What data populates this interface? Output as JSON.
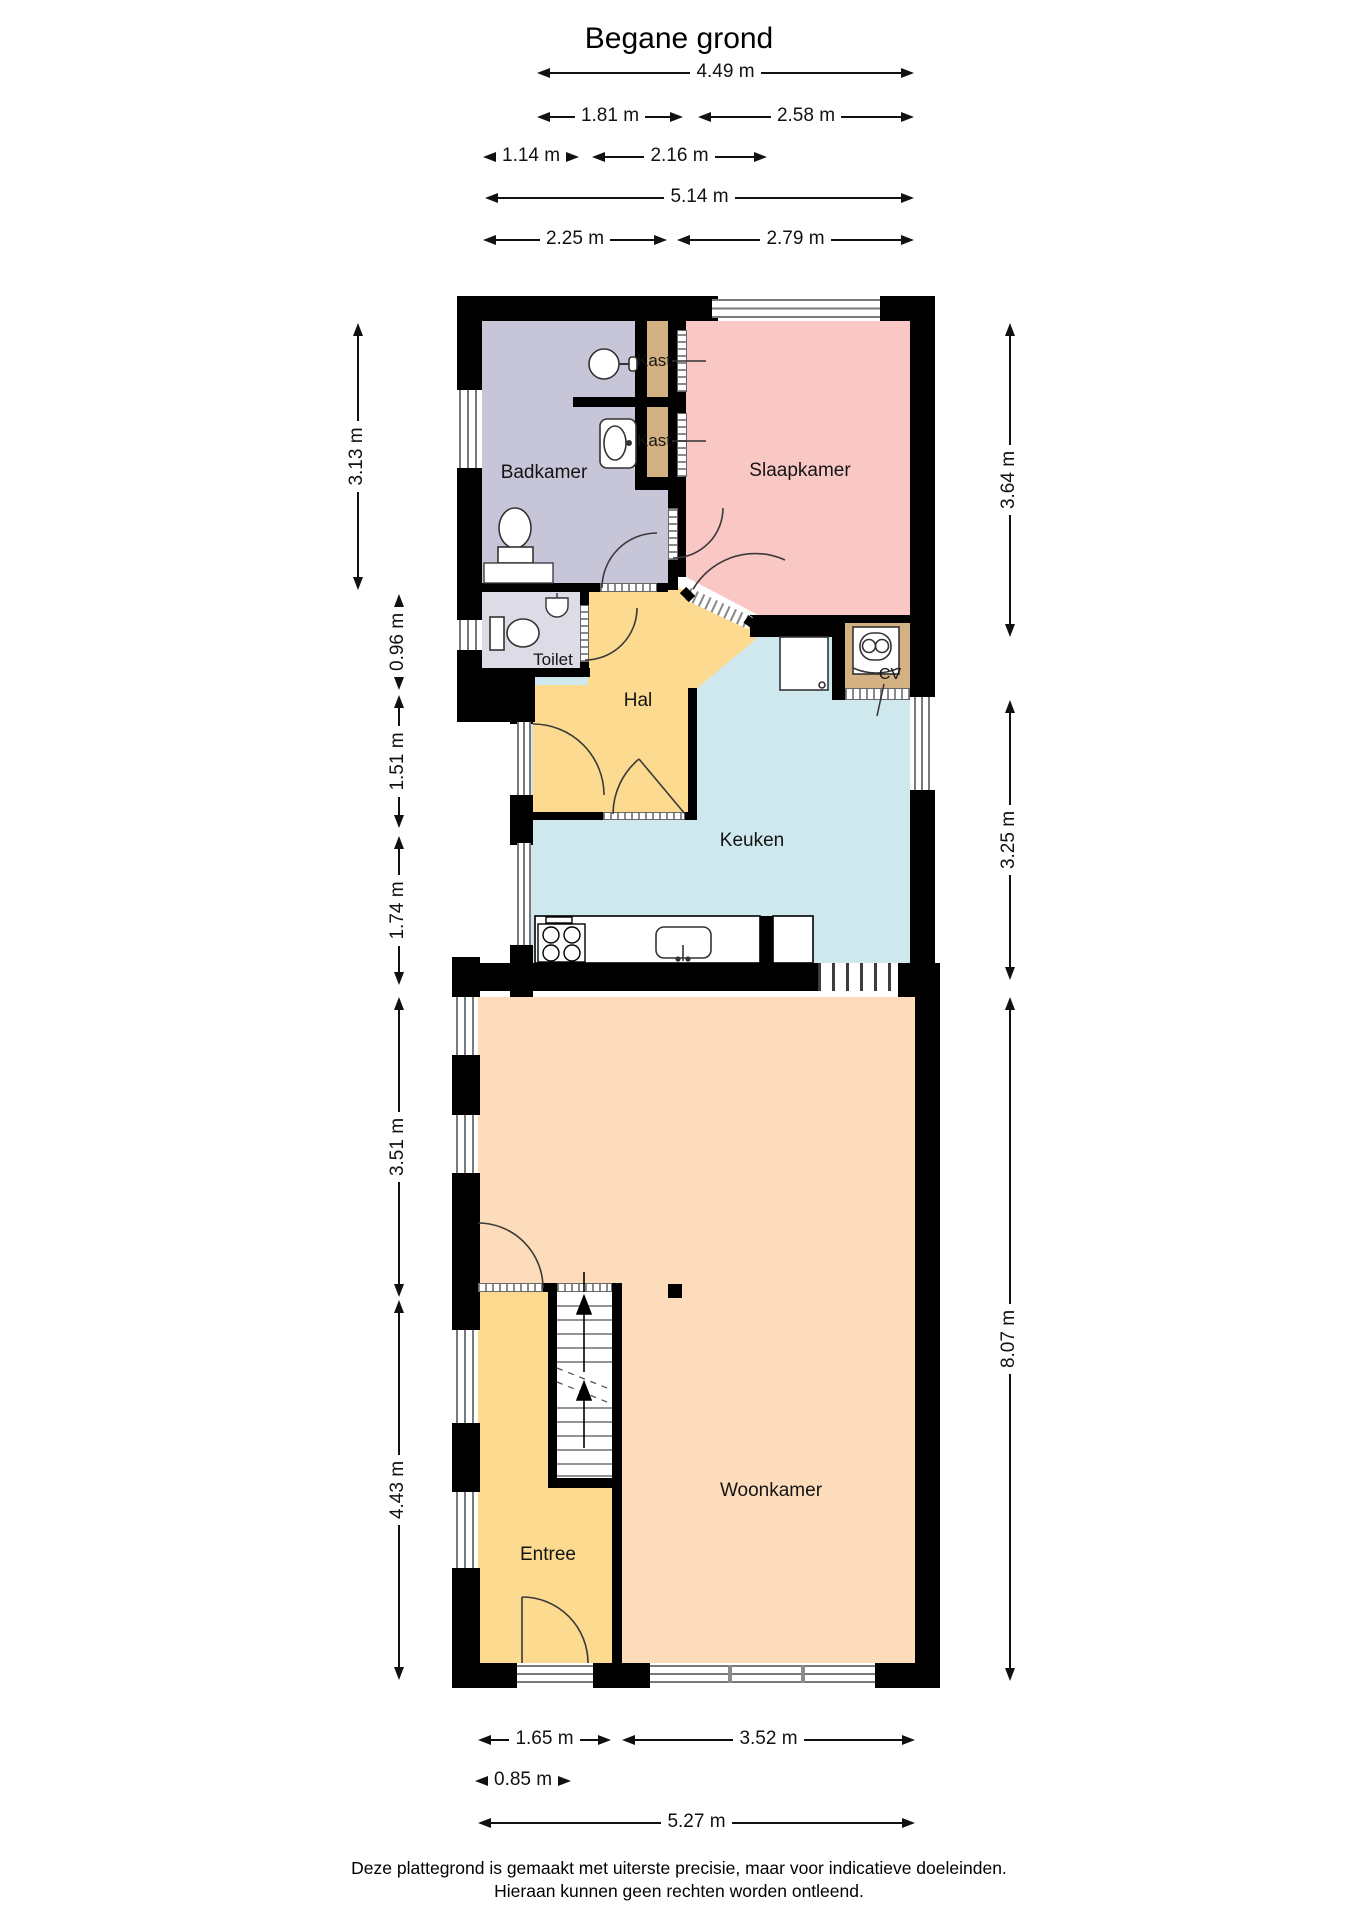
{
  "title": "Begane grond",
  "rooms": {
    "badkamer": "Badkamer",
    "slaapkamer": "Slaapkamer",
    "kast_boven": "Kast",
    "kast_onder": "Kast",
    "toilet": "Toilet",
    "hal": "Hal",
    "cv": "CV",
    "keuken": "Keuken",
    "woonkamer": "Woonkamer",
    "entree": "Entree"
  },
  "dimensions": {
    "top": [
      "4.49 m",
      "1.81 m",
      "2.58 m",
      "1.14 m",
      "2.16 m",
      "5.14 m",
      "2.25 m",
      "2.79 m"
    ],
    "left": [
      "3.13 m",
      "0.96 m",
      "1.51 m",
      "1.74 m",
      "3.51 m",
      "4.43 m"
    ],
    "right": [
      "3.64 m",
      "3.25 m",
      "8.07 m"
    ],
    "bottom": [
      "1.65 m",
      "3.52 m",
      "0.85 m",
      "5.27 m"
    ]
  },
  "footer": {
    "line1": "Deze plattegrond is gemaakt met uiterste precisie, maar voor indicatieve doeleinden.",
    "line2": "Hieraan kunnen geen rechten worden ontleend."
  },
  "colors": {
    "wall": "#000000",
    "badkamer": "#c7c5d8",
    "toilet": "#dcdbe6",
    "slaapkamer": "#f9c8c5",
    "kast": "#d4b183",
    "hal": "#fcda8f",
    "keuken": "#cfe8ee",
    "woonkamer": "#fcdcba",
    "window_line": "#7a7a7a",
    "text": "#1a1a1a"
  }
}
